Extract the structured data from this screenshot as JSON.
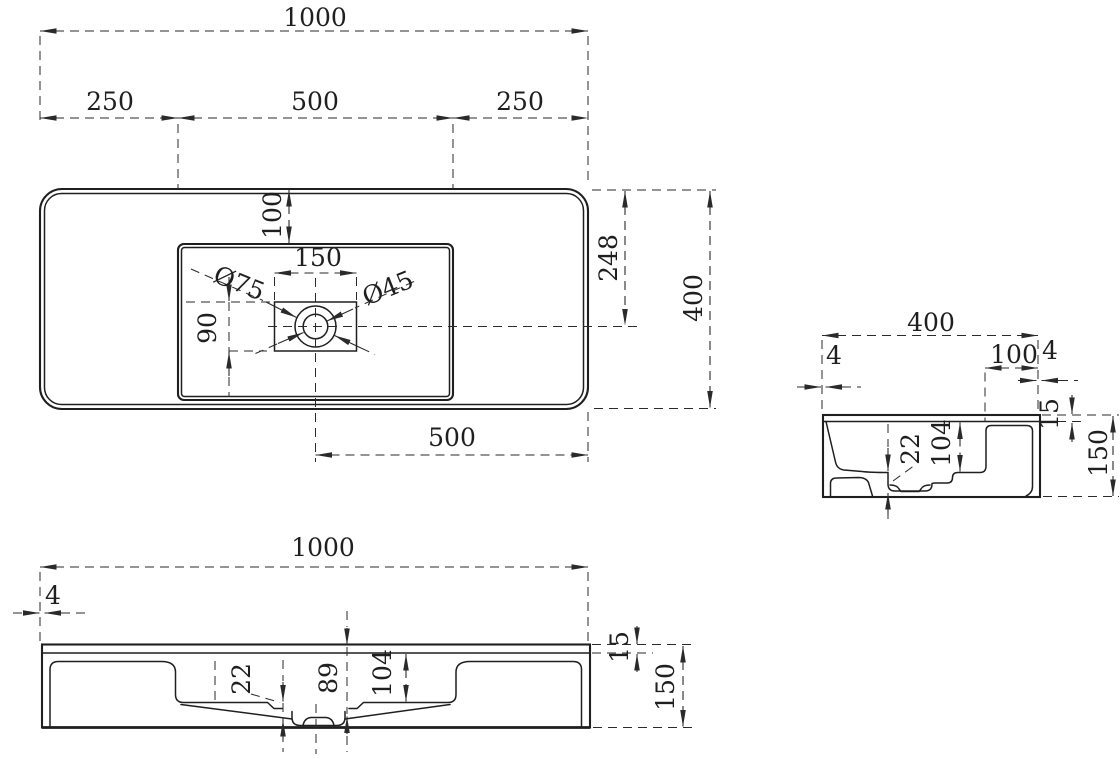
{
  "drawing": {
    "type": "technical-orthographic-drawing",
    "subject": "wall-mounted washbasin",
    "plan": {
      "overall_width": "1000",
      "left_margin": "250",
      "basin_width": "500",
      "right_margin": "250",
      "basin_top_inset": "100",
      "drain_box_width": "150",
      "faucet_hole_dia": "Ø75",
      "drain_dia": "Ø45",
      "drain_box_depth": "90",
      "drain_center_from_back": "248",
      "overall_depth": "400",
      "drain_center_from_right": "500"
    },
    "side": {
      "overall_depth": "400",
      "front_lip": "4",
      "back_shelf_width": "100",
      "back_lip": "4",
      "rim_thickness": "15",
      "overall_height": "150",
      "basin_depth": "104",
      "drain_recess_depth": "22"
    },
    "front": {
      "overall_width": "1000",
      "side_lip": "4",
      "rim_thickness": "15",
      "overall_height": "150",
      "basin_depth": "104",
      "drain_depth": "89",
      "drain_recess_depth": "22"
    }
  }
}
